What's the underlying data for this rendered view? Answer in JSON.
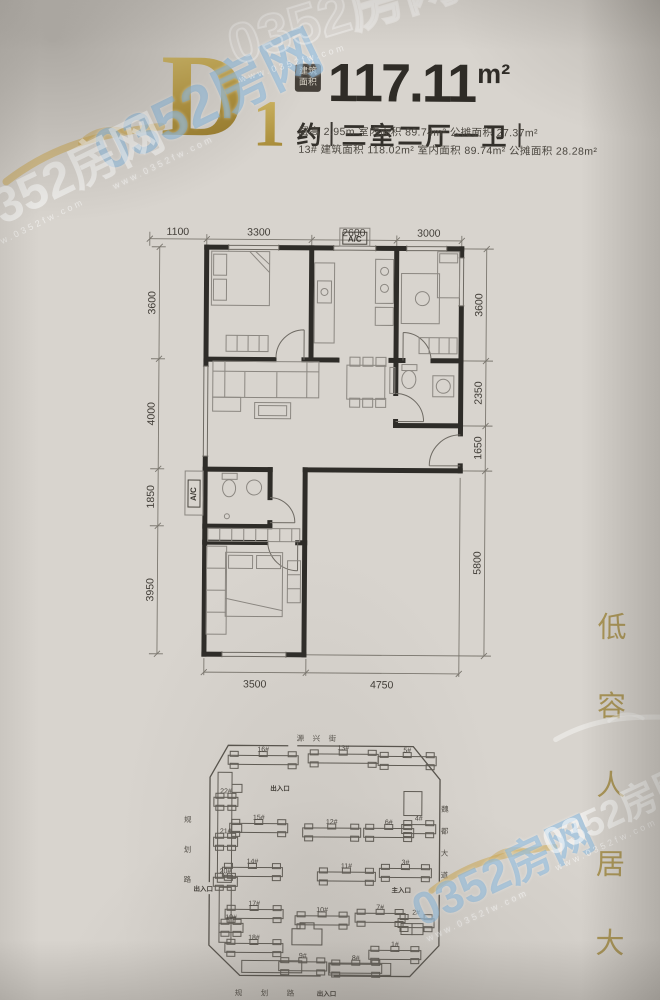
{
  "header": {
    "plan_code_letter": "D",
    "plan_code_number": "1",
    "area_badge": [
      "建筑",
      "面积"
    ],
    "area_value": "117.11",
    "area_unit": "m²",
    "approx_label": "约",
    "layout_label": "三室二厅一卫",
    "detail_line1": "层高 2.95m   室内面积 89.74m²   公摊面积 27.37m²",
    "detail_line2": "13# 建筑面积 118.02m²   室内面积 89.74m²   公摊面积 28.28m²"
  },
  "floorplan": {
    "ac_top": "A/C",
    "ac_side": "A/C",
    "dims": {
      "top": [
        "1100",
        "3300",
        "2600",
        "3000"
      ],
      "left": [
        "3600",
        "4000",
        "1850",
        "3950"
      ],
      "right": [
        "3600",
        "2350",
        "1650",
        "5800"
      ],
      "bottom": [
        "3500",
        "4750"
      ]
    }
  },
  "siteplan": {
    "buildings": [
      {
        "label": "16#",
        "x": 60,
        "y": 18,
        "w": 70
      },
      {
        "label": "13#",
        "x": 140,
        "y": 16,
        "w": 70
      },
      {
        "label": "5#",
        "x": 210,
        "y": 18,
        "w": 58
      },
      {
        "label": "22#",
        "x": 46,
        "y": 60,
        "w": 24
      },
      {
        "label": "15#",
        "x": 62,
        "y": 86,
        "w": 58
      },
      {
        "label": "12#",
        "x": 135,
        "y": 90,
        "w": 58
      },
      {
        "label": "6#",
        "x": 196,
        "y": 90,
        "w": 50
      },
      {
        "label": "4#",
        "x": 234,
        "y": 86,
        "w": 34
      },
      {
        "label": "21#",
        "x": 46,
        "y": 100,
        "w": 24
      },
      {
        "label": "14#",
        "x": 55,
        "y": 130,
        "w": 60
      },
      {
        "label": "11#",
        "x": 150,
        "y": 134,
        "w": 58
      },
      {
        "label": "3#",
        "x": 212,
        "y": 130,
        "w": 52
      },
      {
        "label": "20#",
        "x": 46,
        "y": 140,
        "w": 24
      },
      {
        "label": "17#",
        "x": 58,
        "y": 172,
        "w": 58
      },
      {
        "label": "10#",
        "x": 128,
        "y": 178,
        "w": 54
      },
      {
        "label": "7#",
        "x": 188,
        "y": 175,
        "w": 50
      },
      {
        "label": "2#",
        "x": 231,
        "y": 180,
        "w": 36
      },
      {
        "label": "19#",
        "x": 52,
        "y": 186,
        "w": 24
      },
      {
        "label": "18#",
        "x": 58,
        "y": 206,
        "w": 58
      },
      {
        "label": "9#",
        "x": 112,
        "y": 224,
        "w": 48
      },
      {
        "label": "8#",
        "x": 163,
        "y": 226,
        "w": 52
      },
      {
        "label": "1#",
        "x": 202,
        "y": 212,
        "w": 52
      }
    ],
    "entrances": [
      {
        "label": "出入口",
        "x": 112,
        "y": 58
      },
      {
        "label": "出入口",
        "x": 36,
        "y": 159
      },
      {
        "label": "主入口",
        "x": 234,
        "y": 159
      },
      {
        "label": "出入口",
        "x": 160,
        "y": 263
      }
    ],
    "streets": [
      {
        "text": "源兴街",
        "x": 148,
        "y": 8,
        "dir": "h",
        "gap": 16
      },
      {
        "text": "魏都大道",
        "x": 277,
        "y": 78,
        "dir": "v",
        "gap": 22
      },
      {
        "text": "规划路",
        "x": 20,
        "y": 90,
        "dir": "v",
        "gap": 30
      },
      {
        "text": "规划路",
        "x": 98,
        "y": 263,
        "dir": "h",
        "gap": 26
      }
    ]
  },
  "slogan": {
    "text": "低容人居大盘"
  },
  "watermarks": {
    "small_text": "www.0352fw.com",
    "items": [
      {
        "text": "0352房网",
        "x": 88,
        "y": 72,
        "size": 58,
        "rot": -26,
        "style": "blue",
        "www": true
      },
      {
        "text": "0352房网",
        "x": -38,
        "y": 150,
        "size": 50,
        "rot": -26,
        "style": "white",
        "www": true
      },
      {
        "text": "0352房网",
        "x": 226,
        "y": -16,
        "size": 56,
        "rot": -17,
        "style": "outline",
        "www": true
      },
      {
        "text": "0352房网",
        "x": 408,
        "y": 848,
        "size": 46,
        "rot": -25,
        "style": "blue",
        "www": true
      },
      {
        "text": "0352房网",
        "x": 540,
        "y": 792,
        "size": 38,
        "rot": -25,
        "style": "white",
        "www": true
      }
    ]
  },
  "colors": {
    "gold": "#b0974e",
    "ink": "#33302b",
    "watermark_blue": "#7db0d8",
    "paper": "#d8d4ce"
  }
}
